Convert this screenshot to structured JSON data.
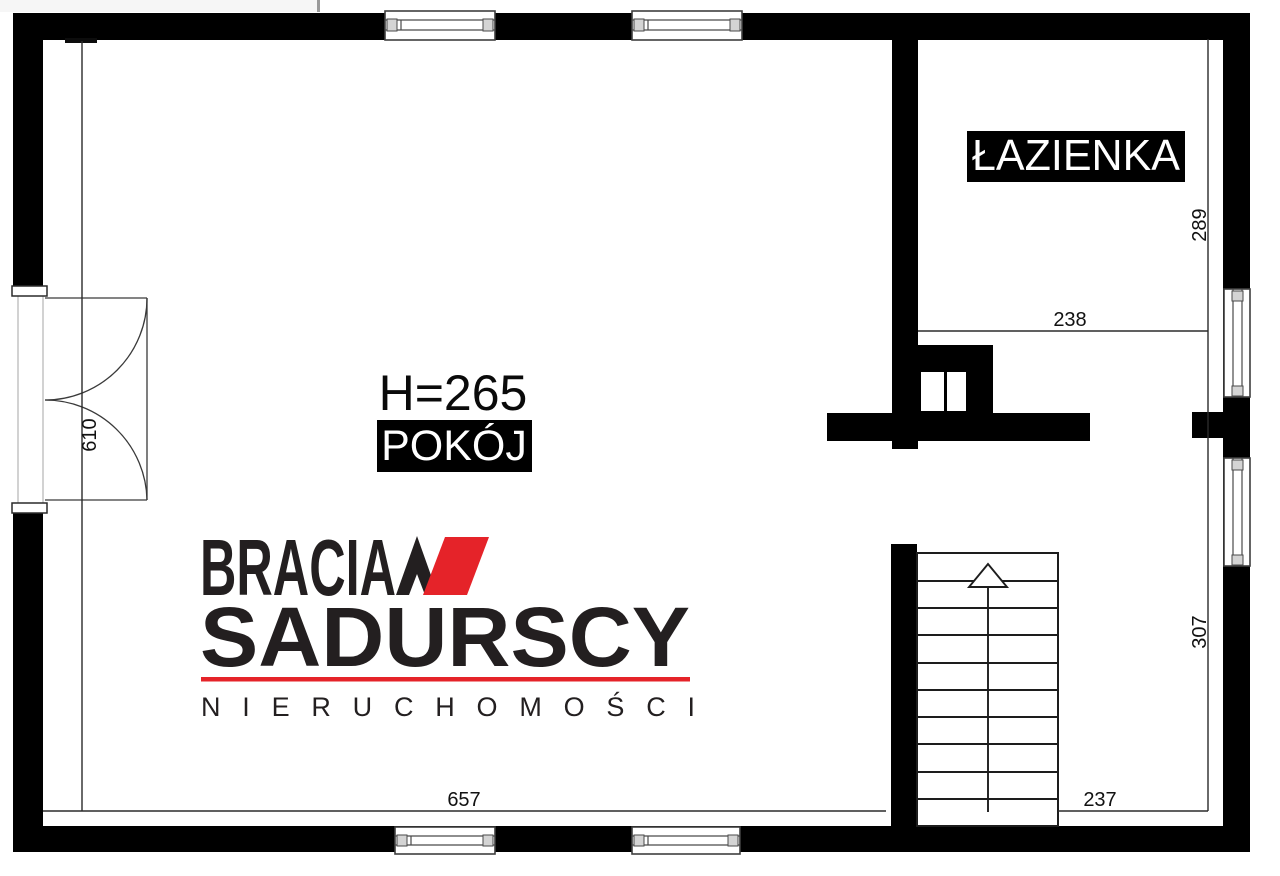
{
  "plan": {
    "labels": {
      "bathroom": "ŁAZIENKA",
      "room": "POKÓJ",
      "room_height": "H=265"
    },
    "dimensions": {
      "door_side": "610",
      "room_bottom": "657",
      "bath_width": "238",
      "bath_depth": "289",
      "stair_side": "307",
      "stair_bottom": "237"
    },
    "colors": {
      "wall": "#000000",
      "background": "#ffffff"
    }
  },
  "branding": {
    "word1": "BRACIA",
    "word2": "SADURSCY",
    "word3": "NIERUCHOMOŚCI",
    "accent_red": "#e52329",
    "ink": "#231f20"
  }
}
